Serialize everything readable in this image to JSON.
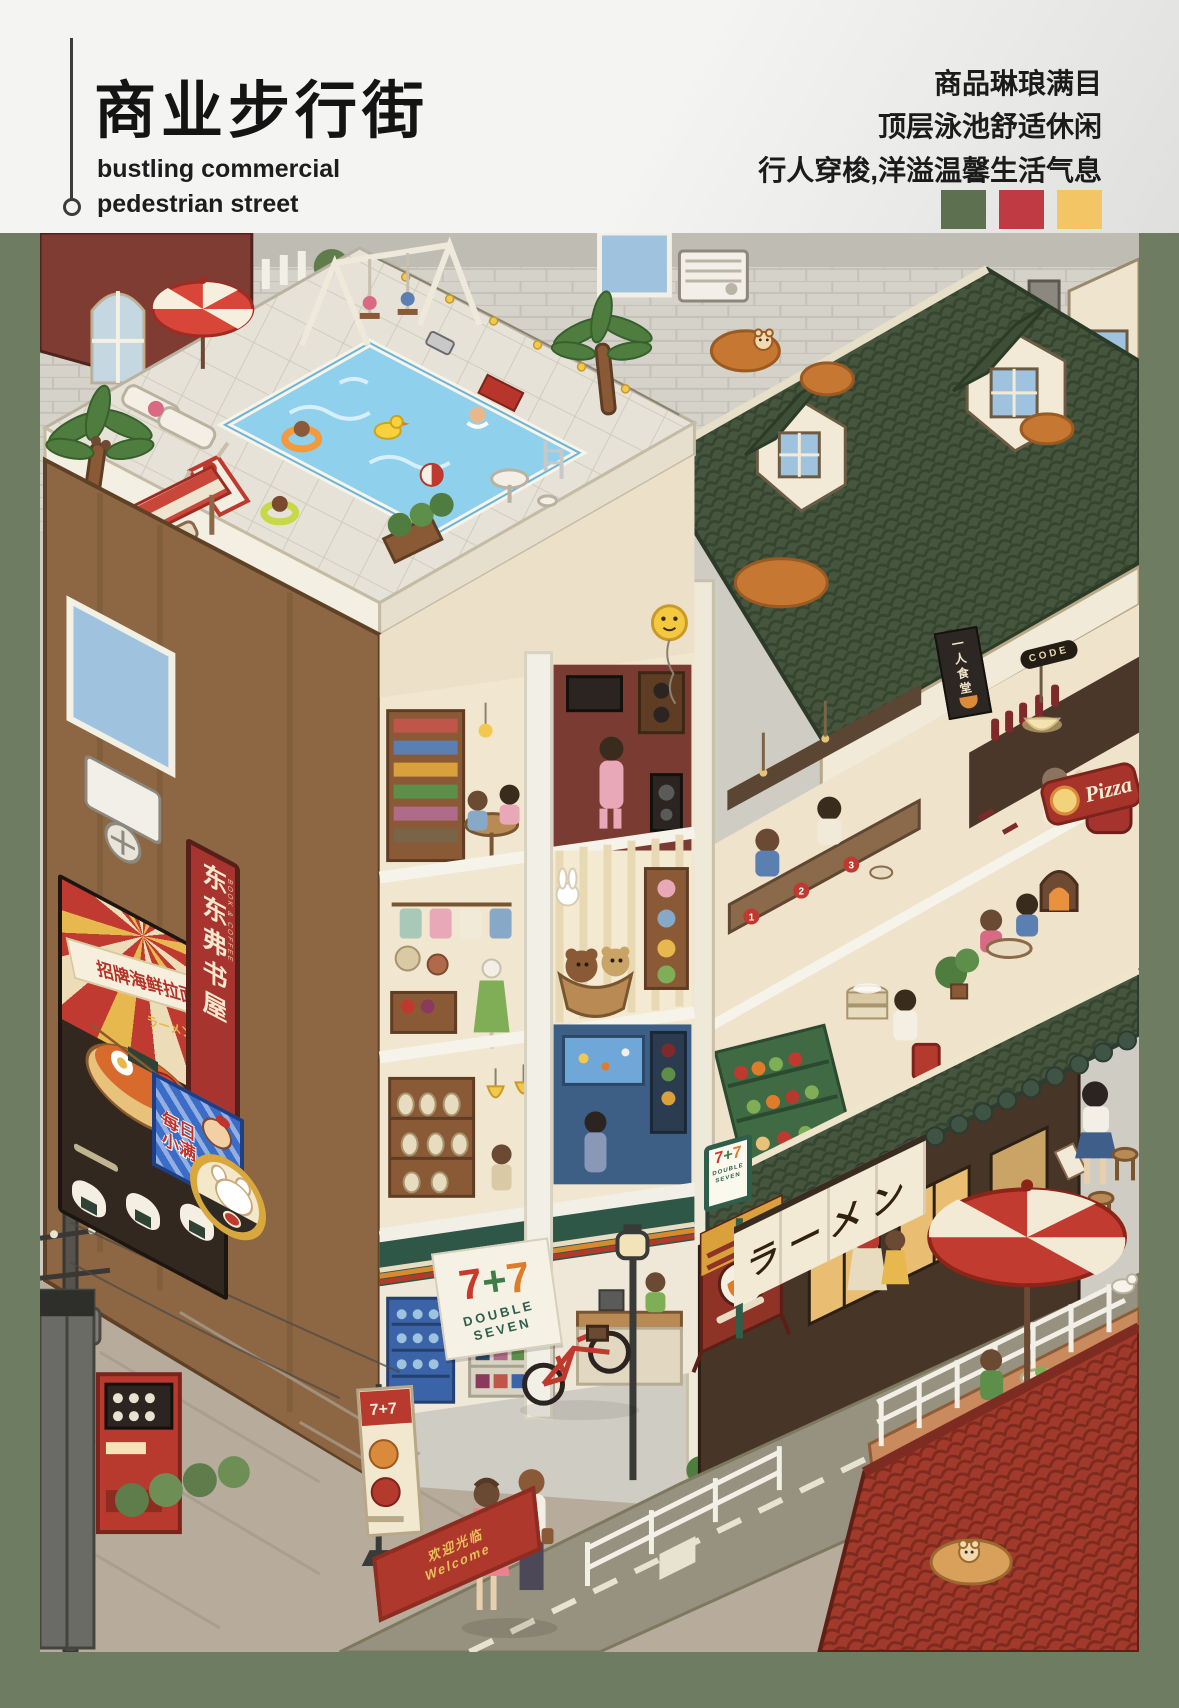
{
  "header": {
    "title": "商业步行街",
    "subtitle_lines": [
      "bustling commercial",
      "pedestrian street"
    ],
    "tagline_lines": [
      "商品琳琅满目",
      "顶层泳池舒适休闲",
      "行人穿梭,洋溢温馨生活气息"
    ],
    "palette": {
      "green": "#5D7150",
      "red": "#BF3A42",
      "yellow": "#F3C564"
    }
  },
  "scene": {
    "ramen_poster": {
      "title": "招牌海鲜拉面",
      "subtitle": "ラーメン"
    },
    "bookstore_sign": {
      "name": "东东弗书屋",
      "tagline": "BOOK & COFFEE"
    },
    "snack_sign": {
      "text": "每日小满"
    },
    "seven_store": {
      "chars": [
        "7",
        "+",
        "7"
      ],
      "logo": "7+7",
      "name_lines": [
        "DOUBLE",
        "SEVEN"
      ]
    },
    "noren": {
      "text": "ラーメン"
    },
    "pizza_sign": {
      "text": "Pizza"
    },
    "solo_dining_poster": {
      "text": "一人食堂"
    },
    "bar_sign": {
      "text": "CODE"
    },
    "welcome_mat": {
      "line1": "欢迎光临",
      "line2": "Welcome"
    },
    "seat_numbers": [
      "1",
      "2",
      "3"
    ]
  }
}
